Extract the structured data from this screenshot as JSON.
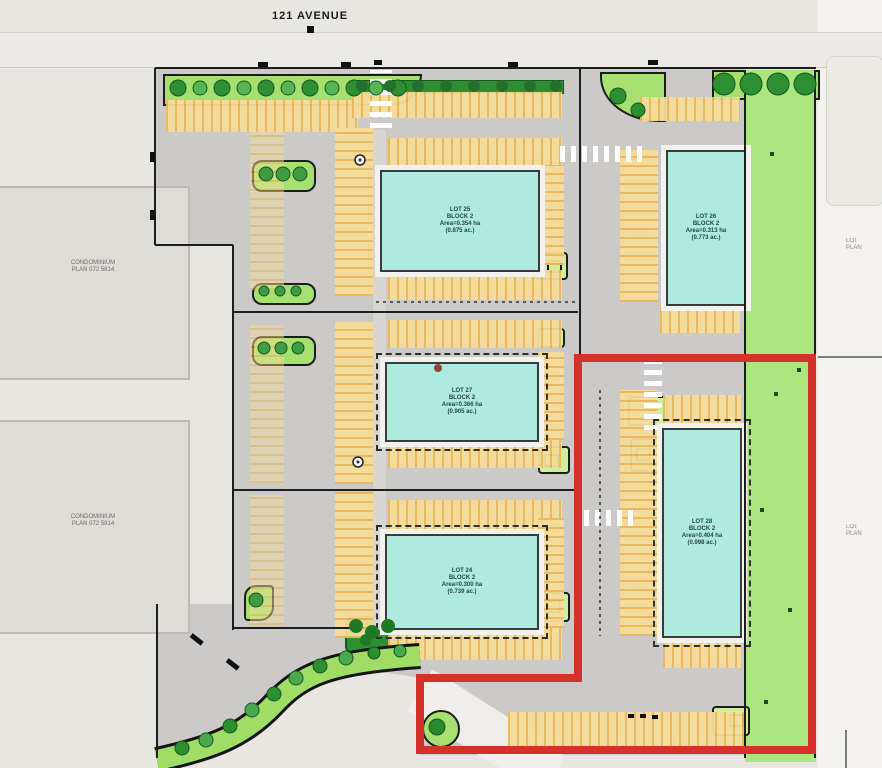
{
  "street": {
    "label": "121 AVENUE"
  },
  "site": {
    "condos": [
      {
        "name": "CONDOMINIUM",
        "plan": "PLAN 072 5814"
      },
      {
        "name": "CONDOMINIUM",
        "plan": "PLAN 072 5814"
      }
    ],
    "lots": [
      {
        "line1": "LOT 25",
        "line2": "BLOCK 2",
        "line3": "Area=0.354 ha",
        "line4": "(0.875 ac.)"
      },
      {
        "line1": "LOT 26",
        "line2": "BLOCK 2",
        "line3": "Area=0.313 ha",
        "line4": "(0.773 ac.)"
      },
      {
        "line1": "LOT 27",
        "line2": "BLOCK 2",
        "line3": "Area=0.366 ha",
        "line4": "(0.905 ac.)"
      },
      {
        "line1": "LOT 24",
        "line2": "BLOCK 2",
        "line3": "Area=0.300 ha",
        "line4": "(0.739 ac.)"
      },
      {
        "line1": "LOT 28",
        "line2": "BLOCK 2",
        "line3": "Area=0.404 ha",
        "line4": "(0.998 ac.)"
      }
    ],
    "adjacent_parcels": [
      {
        "line1": "LOT",
        "line2": "PLAN"
      },
      {
        "line1": "LOT",
        "line2": "PLAN"
      }
    ]
  },
  "legend": {
    "highlight_color": "#d4312a",
    "building_color": "#aeeade",
    "landscape_color": "#a5e070",
    "parking_color": "#f6dc9a",
    "paving_color": "#cbcac8"
  }
}
